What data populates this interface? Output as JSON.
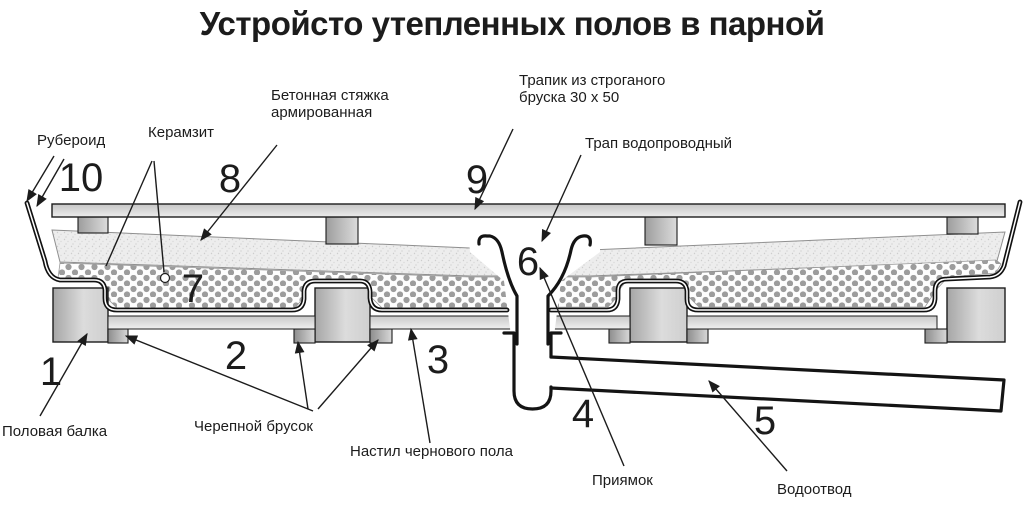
{
  "title": "Устройсто утепленных полов в парной",
  "labels": {
    "ruberoid": "Рубероид",
    "keramzit": "Керамзит",
    "screed": "Бетонная стяжка\nармированная",
    "deck_plank": "Трапик из строганого\nбруска 30 х 50",
    "drain_trap": "Трап водопроводный",
    "floor_beam": "Половая балка",
    "cranial_bar": "Черепной брусок",
    "subfloor": "Настил чернового пола",
    "pit": "Приямок",
    "drainage": "Водоотвод"
  },
  "callouts": {
    "floor_beam": "1",
    "cranial_bar": "2",
    "subfloor": "3",
    "pit": "4",
    "drainage": "5",
    "drain_trap": "6",
    "keramzit": "7",
    "screed": "8",
    "deck_plank": "9",
    "ruberoid": "10"
  },
  "colors": {
    "background": "#ffffff",
    "line": "#1c1c1c",
    "ruberoid_line": "#111111",
    "keramzit_dot": "#9c9c9c",
    "screed_base": "#ededed",
    "wood_dark": "#a6a6a6",
    "wood_light": "#e6e6e6"
  }
}
